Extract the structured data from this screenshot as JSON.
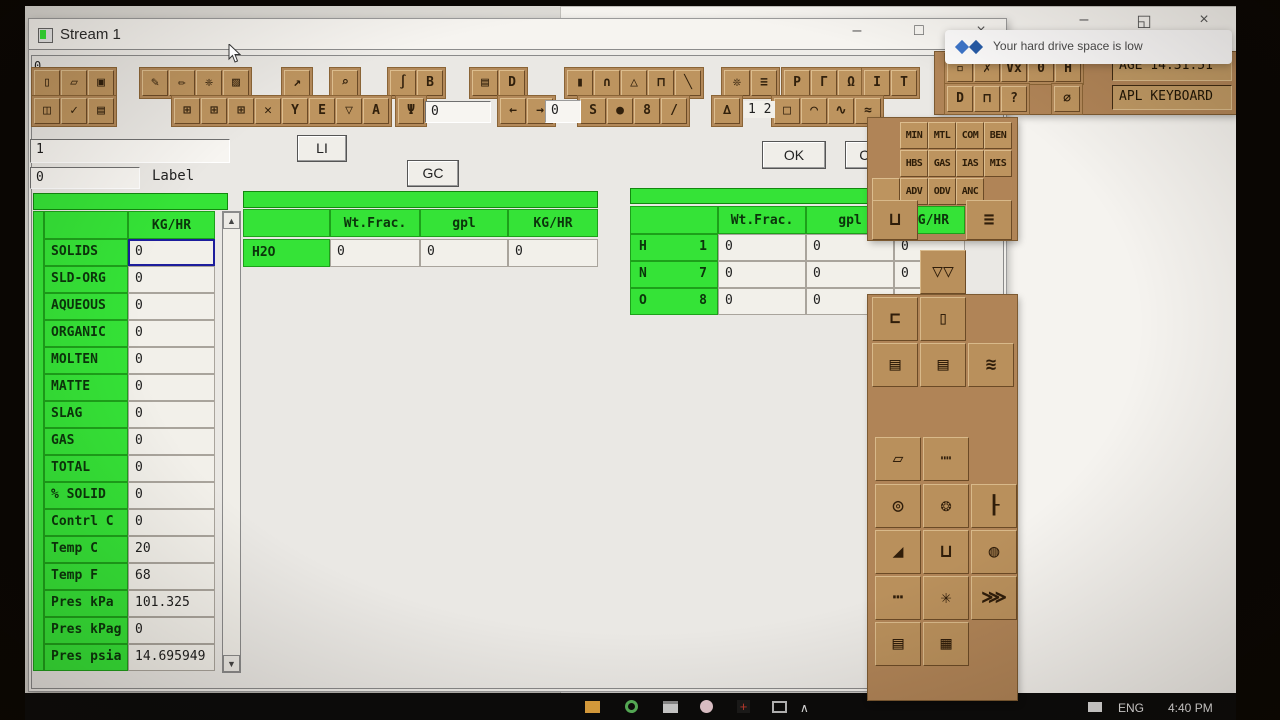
{
  "stream_window": {
    "title": "Stream 1",
    "corner_label": "0",
    "controls": {
      "minimize": "–",
      "maximize": "□",
      "close": "×"
    }
  },
  "background_window": {
    "title_fragment": "Desc",
    "controls": {
      "minimize": "–",
      "restore": "◱",
      "close": "×"
    }
  },
  "notification": {
    "text": "Your hard drive space is low"
  },
  "toolbar": {
    "status_age": "AGE 14:31:51",
    "status_keyboard": "APL KEYBOARD",
    "input_value": "0",
    "band_value": "0",
    "counter": "1 2",
    "groups": {
      "g1": [
        {
          "name": "new-file-icon",
          "glyph": "▯"
        },
        {
          "name": "open-folder-icon",
          "glyph": "▱"
        },
        {
          "name": "save-icon",
          "glyph": "▣"
        }
      ],
      "g2": [
        {
          "name": "flowsheet-tool-icon",
          "glyph": "✎"
        },
        {
          "name": "draw-tool-icon",
          "glyph": "✏"
        },
        {
          "name": "settings-tool-icon",
          "glyph": "❈"
        },
        {
          "name": "edit-box-tool-icon",
          "glyph": "▨"
        }
      ],
      "g3": [
        {
          "name": "arrow-tool-icon",
          "glyph": "↗"
        }
      ],
      "g4": [
        {
          "name": "zoom-tool-icon",
          "glyph": "⌕"
        }
      ],
      "g5": [
        {
          "name": "section-tool-icon",
          "glyph": "∫"
        },
        {
          "name": "report-tool-icon",
          "glyph": "B"
        }
      ],
      "g6": [
        {
          "name": "print-preview-icon",
          "glyph": "▤"
        },
        {
          "name": "shape-tool-icon",
          "glyph": "D"
        }
      ],
      "g7": [
        {
          "name": "dark-doc-icon",
          "glyph": "▮"
        },
        {
          "name": "furnace-tool-icon",
          "glyph": "∩"
        },
        {
          "name": "triangle-tool-icon",
          "glyph": "△"
        },
        {
          "name": "press-tool-icon",
          "glyph": "⊓"
        },
        {
          "name": "line-tool-icon",
          "glyph": "╲"
        }
      ],
      "g8": [
        {
          "name": "star-tool-icon",
          "glyph": "❊"
        },
        {
          "name": "assign-tool-icon",
          "glyph": "≡"
        }
      ],
      "g9": [
        {
          "name": "p-doc-tool-icon",
          "glyph": "P"
        },
        {
          "name": "pipe-tool-icon",
          "glyph": "Γ"
        },
        {
          "name": "valve-tool-icon",
          "glyph": "Ω"
        }
      ],
      "g10": [
        {
          "name": "ibeam-tool-icon",
          "glyph": "I"
        },
        {
          "name": "text-tool-icon",
          "glyph": "T"
        }
      ],
      "g11": [
        {
          "name": "cell-edit-tool-icon",
          "glyph": "▫"
        },
        {
          "name": "delete-check-tool-icon",
          "glyph": "✗"
        },
        {
          "name": "vx-tool-icon",
          "glyph": "Vx"
        },
        {
          "name": "zero-tool-icon",
          "glyph": "0"
        },
        {
          "name": "hold-tool-icon",
          "glyph": "H"
        }
      ],
      "h1": [
        {
          "name": "columns-tool-icon",
          "glyph": "◫"
        },
        {
          "name": "check-tool-icon",
          "glyph": "✓"
        },
        {
          "name": "print-icon",
          "glyph": "▤"
        }
      ],
      "h2": [
        {
          "name": "grid-tool-icon",
          "glyph": "⊞"
        },
        {
          "name": "grid-tool-icon-2",
          "glyph": "⊞"
        },
        {
          "name": "grid-tool-icon-3",
          "glyph": "⊞"
        },
        {
          "name": "delete-tool-icon",
          "glyph": "✕"
        },
        {
          "name": "funnel-tool-icon",
          "glyph": "Y"
        },
        {
          "name": "e-doc-tool-icon",
          "glyph": "E"
        },
        {
          "name": "filter-tool-icon",
          "glyph": "▽"
        },
        {
          "name": "text-a-tool-icon",
          "glyph": "A"
        }
      ],
      "h3": [
        {
          "name": "sampler-tool-icon",
          "glyph": "Ψ"
        }
      ],
      "h4": [
        {
          "name": "arrow-left-icon",
          "glyph": "←"
        },
        {
          "name": "arrow-right-icon",
          "glyph": "→"
        }
      ],
      "h5": [
        {
          "name": "calculator-s-icon",
          "glyph": "S"
        },
        {
          "name": "calculator-dark-icon",
          "glyph": "●"
        },
        {
          "name": "calculator-8-icon",
          "glyph": "8"
        },
        {
          "name": "calculator-slash-icon",
          "glyph": "/"
        }
      ],
      "h6": [
        {
          "name": "scales-tool-icon",
          "glyph": "∆"
        }
      ],
      "h7": [
        {
          "name": "square-tool-icon",
          "glyph": "□"
        },
        {
          "name": "curve-tool-icon",
          "glyph": "◠"
        },
        {
          "name": "curve-tool-icon-2",
          "glyph": "∿"
        },
        {
          "name": "curve-tool-icon-3",
          "glyph": "≈"
        }
      ],
      "h8": [
        {
          "name": "dde-tool-icon",
          "glyph": "D"
        },
        {
          "name": "lock-tool-icon",
          "glyph": "⊓"
        },
        {
          "name": "help-tool-icon",
          "glyph": "?"
        }
      ],
      "h9": [
        {
          "name": "disable-tool-icon",
          "glyph": "∅"
        }
      ]
    }
  },
  "dialog": {
    "stream_number": "1",
    "label_value": "0",
    "label_caption": "Label",
    "li_button": "LI",
    "gc_button": "GC",
    "ok_button": "OK",
    "cancel_button": "Cancel"
  },
  "phase_table": {
    "header": "KG/HR",
    "rows": [
      {
        "label": "SOLIDS",
        "value": "0",
        "selected": true
      },
      {
        "label": "SLD-ORG",
        "value": "0"
      },
      {
        "label": "AQUEOUS",
        "value": "0"
      },
      {
        "label": "ORGANIC",
        "value": "0"
      },
      {
        "label": "MOLTEN",
        "value": "0"
      },
      {
        "label": "MATTE",
        "value": "0"
      },
      {
        "label": "SLAG",
        "value": "0"
      },
      {
        "label": "GAS",
        "value": "0"
      },
      {
        "label": "TOTAL",
        "value": "0"
      },
      {
        "label": "% SOLID",
        "value": "0"
      },
      {
        "label": "Contrl C",
        "value": "0"
      },
      {
        "label": "Temp C",
        "value": "20"
      },
      {
        "label": "Temp F",
        "value": "68"
      },
      {
        "label": "Pres kPa",
        "value": "101.325"
      },
      {
        "label": "Pres kPag",
        "value": "0"
      },
      {
        "label": "Pres psia",
        "value": "14.695949"
      }
    ]
  },
  "component_table": {
    "headers": [
      "Wt.Frac.",
      "gpl",
      "KG/HR"
    ],
    "rows": [
      {
        "label": "H2O",
        "values": [
          "0",
          "0",
          "0"
        ]
      }
    ]
  },
  "element_table": {
    "headers": [
      "Wt.Frac.",
      "gpl",
      "KG/HR"
    ],
    "rows": [
      {
        "symbol": "H",
        "number": "1",
        "values": [
          "0",
          "0",
          "0"
        ]
      },
      {
        "symbol": "N",
        "number": "7",
        "values": [
          "0",
          "0",
          "0"
        ]
      },
      {
        "symbol": "O",
        "number": "8",
        "values": [
          "0",
          "0",
          ""
        ]
      }
    ]
  },
  "palette": {
    "db_buttons": [
      "MIN",
      "MTL",
      "COM",
      "BEN",
      "HBS",
      "GAS",
      "IAS",
      "MIS",
      "ADV",
      "ODV",
      "ANC"
    ],
    "equipment": [
      {
        "name": "vessel-icon",
        "glyph": "⊔"
      },
      {
        "name": "streams-list-icon",
        "glyph": "≡"
      },
      {
        "name": "screen-icon",
        "glyph": "▽▽"
      },
      {
        "name": "crusher-icon",
        "glyph": "⊏"
      },
      {
        "name": "tank-icon",
        "glyph": "▯"
      },
      {
        "name": "mill-icon",
        "glyph": "▤"
      },
      {
        "name": "mill-icon-2",
        "glyph": "▤"
      },
      {
        "name": "heat-exchanger-icon",
        "glyph": "≋"
      },
      {
        "name": "flotation-cell-icon",
        "glyph": "▱"
      },
      {
        "name": "conveyor-icon",
        "glyph": "┉"
      },
      {
        "name": "pump-icon",
        "glyph": "◎"
      },
      {
        "name": "grinding-mill-icon",
        "glyph": "❂"
      },
      {
        "name": "column-icon",
        "glyph": "┠"
      },
      {
        "name": "stairs-icon",
        "glyph": "◢"
      },
      {
        "name": "launder-icon",
        "glyph": "⊔"
      },
      {
        "name": "ball-mill-icon",
        "glyph": "◍"
      },
      {
        "name": "belt-feeder-icon",
        "glyph": "┅"
      },
      {
        "name": "mixer-icon",
        "glyph": "✳"
      },
      {
        "name": "screw-conveyor-icon",
        "glyph": "⋙"
      },
      {
        "name": "filter-press-icon",
        "glyph": "▤"
      },
      {
        "name": "filter-press-icon-2",
        "glyph": "▦"
      }
    ]
  },
  "taskbar": {
    "language": "ENG",
    "time": "4:40 PM",
    "tray_expand": "∧"
  },
  "colors": {
    "green": "#35e337",
    "tan": "#b3895a",
    "tan_dark": "#6b4a26",
    "selection": "#1d1d9c"
  }
}
